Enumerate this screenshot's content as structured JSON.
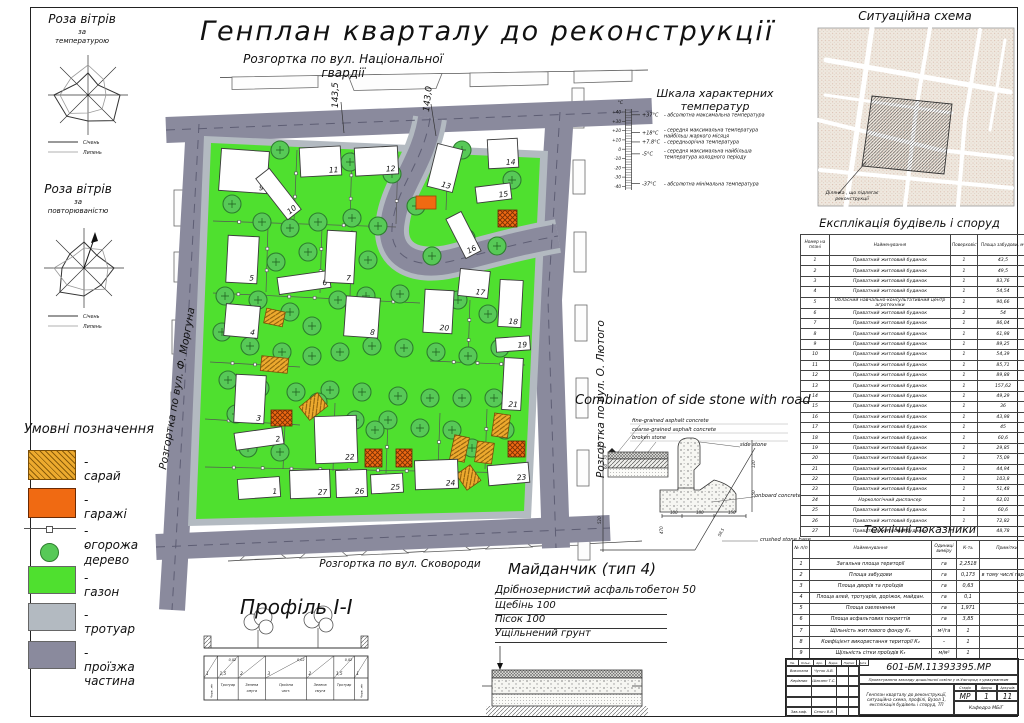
{
  "title": {
    "main": "Генплан кварталу до реконструкції",
    "subtitle": "Розгортка по вул. Національної гвардії"
  },
  "wind_roses": {
    "rose1": {
      "title": "Роза вітрів",
      "sub1": "за",
      "sub2": "температурою",
      "legend": [
        {
          "label": "Січень"
        },
        {
          "label": "Липень"
        }
      ]
    },
    "rose2": {
      "title": "Роза вітрів",
      "sub1": "за",
      "sub2": "повторюваністю",
      "legend": [
        {
          "label": "Січень"
        },
        {
          "label": "Липень"
        }
      ]
    }
  },
  "legend": {
    "title": "Умовні позначення",
    "items": [
      {
        "key": "shed",
        "label": "- сарай",
        "type": "hatch-diag",
        "fill": "#EDAA2E"
      },
      {
        "key": "garages",
        "label": "- гаражі",
        "type": "hatch-cross",
        "fill": "#F06A12"
      },
      {
        "key": "fence",
        "label": "- огорожа",
        "type": "fence-line"
      },
      {
        "key": "tree",
        "label": "- дерево",
        "type": "tree"
      },
      {
        "key": "lawn",
        "label": "- газон",
        "type": "solid",
        "fill": "#4FE02F"
      },
      {
        "key": "sidewalk",
        "label": "- тротуар",
        "type": "solid",
        "fill": "#B3BAC1"
      },
      {
        "key": "roadway",
        "label": "- проїзжа частина",
        "type": "solid",
        "fill": "#8A8A9D"
      }
    ]
  },
  "plan": {
    "street_left": "Розгортка по вул. Ф. Моргуна",
    "street_right": "Розгортка по вул. О. Лютого",
    "street_bottom": "Розгортка по вул. Сковороди",
    "elevations": [
      "143,5",
      "143,0"
    ],
    "buildings": [
      [
        1,
        238,
        478,
        42,
        20,
        -4
      ],
      [
        2,
        235,
        430,
        48,
        17,
        -8
      ],
      [
        3,
        235,
        375,
        30,
        48,
        3
      ],
      [
        4,
        225,
        305,
        34,
        32,
        5
      ],
      [
        5,
        227,
        236,
        31,
        47,
        3
      ],
      [
        6,
        278,
        274,
        52,
        17,
        -8
      ],
      [
        7,
        326,
        231,
        29,
        52,
        3
      ],
      [
        8,
        345,
        297,
        34,
        40,
        4
      ],
      [
        9,
        220,
        150,
        48,
        42,
        4
      ],
      [
        10,
        270,
        168,
        17,
        52,
        -38
      ],
      [
        11,
        300,
        147,
        41,
        29,
        -3
      ],
      [
        12,
        355,
        147,
        43,
        28,
        -3
      ],
      [
        13,
        432,
        146,
        26,
        44,
        14
      ],
      [
        14,
        488,
        139,
        30,
        29,
        -3
      ],
      [
        15,
        476,
        185,
        35,
        16,
        -7
      ],
      [
        16,
        455,
        213,
        17,
        44,
        -27
      ],
      [
        17,
        459,
        270,
        30,
        27,
        6
      ],
      [
        18,
        499,
        280,
        23,
        47,
        3
      ],
      [
        19,
        496,
        337,
        34,
        14,
        -4
      ],
      [
        20,
        424,
        290,
        29,
        43,
        3
      ],
      [
        21,
        503,
        358,
        19,
        52,
        3
      ],
      [
        22,
        315,
        416,
        42,
        47,
        -2
      ],
      [
        23,
        488,
        464,
        41,
        20,
        -5
      ],
      [
        24,
        415,
        460,
        43,
        29,
        -2
      ],
      [
        25,
        371,
        474,
        32,
        19,
        -3
      ],
      [
        26,
        336,
        470,
        31,
        27,
        -2
      ],
      [
        27,
        290,
        470,
        40,
        28,
        -2
      ]
    ],
    "trees": [
      [
        280,
        150
      ],
      [
        350,
        162
      ],
      [
        392,
        174
      ],
      [
        462,
        150
      ],
      [
        512,
        180
      ],
      [
        232,
        204
      ],
      [
        262,
        222
      ],
      [
        290,
        228
      ],
      [
        318,
        222
      ],
      [
        352,
        218
      ],
      [
        378,
        226
      ],
      [
        416,
        206
      ],
      [
        240,
        256
      ],
      [
        276,
        262
      ],
      [
        308,
        252
      ],
      [
        340,
        246
      ],
      [
        368,
        260
      ],
      [
        432,
        256
      ],
      [
        466,
        238
      ],
      [
        497,
        246
      ],
      [
        225,
        296
      ],
      [
        258,
        300
      ],
      [
        290,
        312
      ],
      [
        312,
        326
      ],
      [
        338,
        300
      ],
      [
        366,
        296
      ],
      [
        400,
        294
      ],
      [
        458,
        300
      ],
      [
        488,
        314
      ],
      [
        222,
        332
      ],
      [
        250,
        346
      ],
      [
        282,
        352
      ],
      [
        312,
        356
      ],
      [
        340,
        352
      ],
      [
        372,
        346
      ],
      [
        404,
        348
      ],
      [
        436,
        352
      ],
      [
        468,
        356
      ],
      [
        500,
        348
      ],
      [
        228,
        380
      ],
      [
        260,
        388
      ],
      [
        296,
        392
      ],
      [
        330,
        390
      ],
      [
        362,
        392
      ],
      [
        398,
        396
      ],
      [
        430,
        398
      ],
      [
        462,
        398
      ],
      [
        494,
        398
      ],
      [
        236,
        414
      ],
      [
        318,
        402
      ],
      [
        355,
        420
      ],
      [
        388,
        420
      ],
      [
        420,
        428
      ],
      [
        452,
        430
      ],
      [
        472,
        448
      ],
      [
        248,
        448
      ],
      [
        280,
        452
      ],
      [
        505,
        430
      ],
      [
        375,
        430
      ]
    ],
    "sheds": [
      [
        265,
        310,
        19,
        15,
        12
      ],
      [
        261,
        357,
        27,
        15,
        6
      ],
      [
        302,
        398,
        23,
        17,
        -38
      ],
      [
        452,
        436,
        15,
        25,
        12
      ],
      [
        476,
        442,
        17,
        21,
        8
      ],
      [
        460,
        468,
        17,
        19,
        -35
      ],
      [
        493,
        414,
        16,
        23,
        8
      ]
    ],
    "garages": [
      [
        271,
        410,
        21,
        16,
        0
      ],
      [
        365,
        449,
        17,
        18,
        0
      ],
      [
        396,
        449,
        16,
        18,
        0
      ],
      [
        498,
        210,
        19,
        17,
        0
      ],
      [
        508,
        441,
        17,
        16,
        0
      ]
    ],
    "garage_solid": [
      [
        416,
        196,
        20,
        13,
        0
      ]
    ],
    "fences": [
      [
        297,
        150,
        294,
        220
      ],
      [
        352,
        152,
        350,
        222
      ],
      [
        398,
        155,
        396,
        224
      ],
      [
        213,
        221,
        396,
        227
      ],
      [
        268,
        227,
        266,
        292
      ],
      [
        322,
        227,
        320,
        293
      ],
      [
        213,
        293,
        340,
        299
      ],
      [
        340,
        299,
        420,
        303
      ],
      [
        448,
        152,
        446,
        210
      ],
      [
        470,
        300,
        468,
        360
      ],
      [
        430,
        361,
        525,
        365
      ],
      [
        210,
        362,
        300,
        367
      ],
      [
        205,
        419,
        300,
        425
      ],
      [
        205,
        467,
        522,
        473
      ],
      [
        285,
        425,
        283,
        469
      ],
      [
        335,
        403,
        333,
        471
      ],
      [
        388,
        421,
        386,
        473
      ],
      [
        440,
        413,
        438,
        471
      ],
      [
        487,
        409,
        485,
        469
      ],
      [
        352,
        230,
        350,
        296
      ]
    ]
  },
  "temperature_scale": {
    "title": "Шкала характерних температур",
    "unit": "°C",
    "ticks": [
      "+40",
      "+30",
      "+20",
      "+10",
      "0",
      "-10",
      "-20",
      "-30",
      "-40"
    ],
    "entries": [
      {
        "t": 37,
        "value": "+37°C",
        "lines": [
          "- абсолютна максимальна температура"
        ]
      },
      {
        "t": 18,
        "value": "+18°C",
        "lines": [
          "- середня максимальна температура",
          "найбільш жаркого місяця"
        ]
      },
      {
        "t": 7.8,
        "value": "+7.8°C",
        "lines": [
          "- середньорічна температура"
        ]
      },
      {
        "t": -5,
        "value": "-5°C",
        "lines": [
          "- середня максимальна найбільша",
          "температура холодного періоду"
        ]
      },
      {
        "t": -37,
        "value": "-37°C",
        "lines": [
          "- абсолютна мінімальна температура"
        ]
      }
    ]
  },
  "situational": {
    "title": "Ситуаційна схема",
    "note_line1": "Ділянка , що підлягає",
    "note_line2": "реконструкції"
  },
  "explication": {
    "title": "Експлікація будівель і споруд",
    "headers": [
      "Номер на плані",
      "Найменування",
      "Поверховість",
      "Площа забудови, м²"
    ],
    "rows": [
      [
        "1",
        "Приватний житловий будинок",
        "1",
        "43,5"
      ],
      [
        "2",
        "Приватний житловий будинок",
        "1",
        "49,5"
      ],
      [
        "3",
        "Приватний житловий будинок",
        "1",
        "83,76"
      ],
      [
        "4",
        "Приватний житловий будинок",
        "1",
        "54,54"
      ],
      [
        "5",
        "Обласний навчально-консультативний центр агротехніки",
        "1",
        "90,66"
      ],
      [
        "6",
        "Приватний житловий будинок",
        "2",
        "54"
      ],
      [
        "7",
        "Приватний житловий будинок",
        "1",
        "86,04"
      ],
      [
        "8",
        "Приватний житловий будинок",
        "1",
        "61,98"
      ],
      [
        "9",
        "Приватний житловий будинок",
        "1",
        "89,25"
      ],
      [
        "10",
        "Приватний житловий будинок",
        "1",
        "54,39"
      ],
      [
        "11",
        "Приватний житловий будинок",
        "1",
        "85,71"
      ],
      [
        "12",
        "Приватний житловий будинок",
        "1",
        "89,88"
      ],
      [
        "13",
        "Приватний житловий будинок",
        "1",
        "157,62"
      ],
      [
        "14",
        "Приватний житловий будинок",
        "1",
        "49,29"
      ],
      [
        "15",
        "Приватний житловий будинок",
        "1",
        "36"
      ],
      [
        "16",
        "Приватний житловий будинок",
        "1",
        "43,98"
      ],
      [
        "17",
        "Приватний житловий будинок",
        "1",
        "45"
      ],
      [
        "18",
        "Приватний житловий будинок",
        "1",
        "60,6"
      ],
      [
        "19",
        "Приватний житловий будинок",
        "1",
        "29,85"
      ],
      [
        "20",
        "Приватний житловий будинок",
        "1",
        "75,09"
      ],
      [
        "21",
        "Приватний житловий будинок",
        "1",
        "44,94"
      ],
      [
        "22",
        "Приватний житловий будинок",
        "1",
        "103,8"
      ],
      [
        "23",
        "Приватний житловий будинок",
        "1",
        "51,48"
      ],
      [
        "24",
        "Наркологічний диспансер",
        "1",
        "62,01"
      ],
      [
        "25",
        "Приватний житловий будинок",
        "1",
        "60,6"
      ],
      [
        "26",
        "Приватний житловий будинок",
        "1",
        "72,82"
      ],
      [
        "27",
        "Приватний житловий будинок",
        "1",
        "48,78"
      ]
    ]
  },
  "detail": {
    "title": "Combination of side stone with road",
    "labels": [
      "fine-grained asphalt concrete",
      "coarse-grained asphalt concrete",
      "broken stone",
      "side stone",
      "onboard concrete",
      "crushed stone base"
    ],
    "dims": [
      "150",
      "70",
      "60",
      "520",
      "470",
      "100",
      "180",
      "150",
      "120",
      "150",
      "58,5"
    ]
  },
  "tech": {
    "title": "Технічні показники",
    "headers": [
      "№ п/п",
      "Найменування",
      "Одиниці виміру",
      "К-ть",
      "Примітки"
    ],
    "rows": [
      [
        "1",
        "Загальна площа території",
        "га",
        "2,2518",
        ""
      ],
      [
        "2",
        "Площа забудови",
        "га",
        "0,173",
        "в тому числі гаражі"
      ],
      [
        "3",
        "Площа дворів та проїздів",
        "га",
        "0,63",
        ""
      ],
      [
        "4",
        "Площа алей, тротуарів, доріжок, майдан.",
        "га",
        "0,1",
        ""
      ],
      [
        "5",
        "Площа озеленення",
        "га",
        "1,971",
        ""
      ],
      [
        "6",
        "Площа асфальтових покриттів",
        "га",
        "3,85",
        ""
      ],
      [
        "7",
        "Щільність житлового фонду К₁",
        "м²/га",
        "1",
        ""
      ],
      [
        "8",
        "Коефіцієнт використання території К₂",
        "–",
        "1",
        ""
      ],
      [
        "9",
        "Щільність сітки проїздів К₃",
        "м/м²",
        "1",
        ""
      ]
    ]
  },
  "profile": {
    "title": "Профіль І-І",
    "slope": "0,02",
    "widths": [
      "1",
      "1,5",
      "2",
      "3",
      "2",
      "1,5",
      "1"
    ],
    "labels": [
      "Черв. лін",
      "Тротуар",
      "Зелена смуга",
      "Проїзна част.",
      "Зелена смуга",
      "Тротуар",
      "Черв. лін"
    ]
  },
  "playground": {
    "title": "Майданчик (тип 4)",
    "layers": [
      "Дрібнозернистий асфальтобетон 50",
      "Щебінь 100",
      "Пісок 100",
      "Ущільнений грунт"
    ]
  },
  "stamp": {
    "doc_number": "601-БМ.11393395.МР",
    "project": "Проектування закладу дошкільної освіти у м.Ужгород з урахуванням",
    "sheet_title": "Генплан кварталу до реконструкції, ситуаційна схема, профілі, Вузол 1, експлікація будівель і споруд, ТП",
    "stage_label": "Стадія",
    "sheet_label": "Аркуш",
    "sheets_label": "Аркушів",
    "stage": "МР",
    "sheet": "1",
    "sheets": "11",
    "department": "Кафедра МБіГ",
    "header_cells": [
      "Зм.",
      "Кільк.",
      "Арк.",
      "№док.",
      "Підпис",
      "Дата"
    ],
    "rows": [
      [
        "Виконала",
        "Чуток А.В."
      ],
      [
        "Керівник",
        "Шеканн Т.С."
      ],
      [
        "",
        ""
      ],
      [
        "",
        ""
      ],
      [
        "Зав.каф.",
        "Сенич В.В."
      ]
    ]
  }
}
